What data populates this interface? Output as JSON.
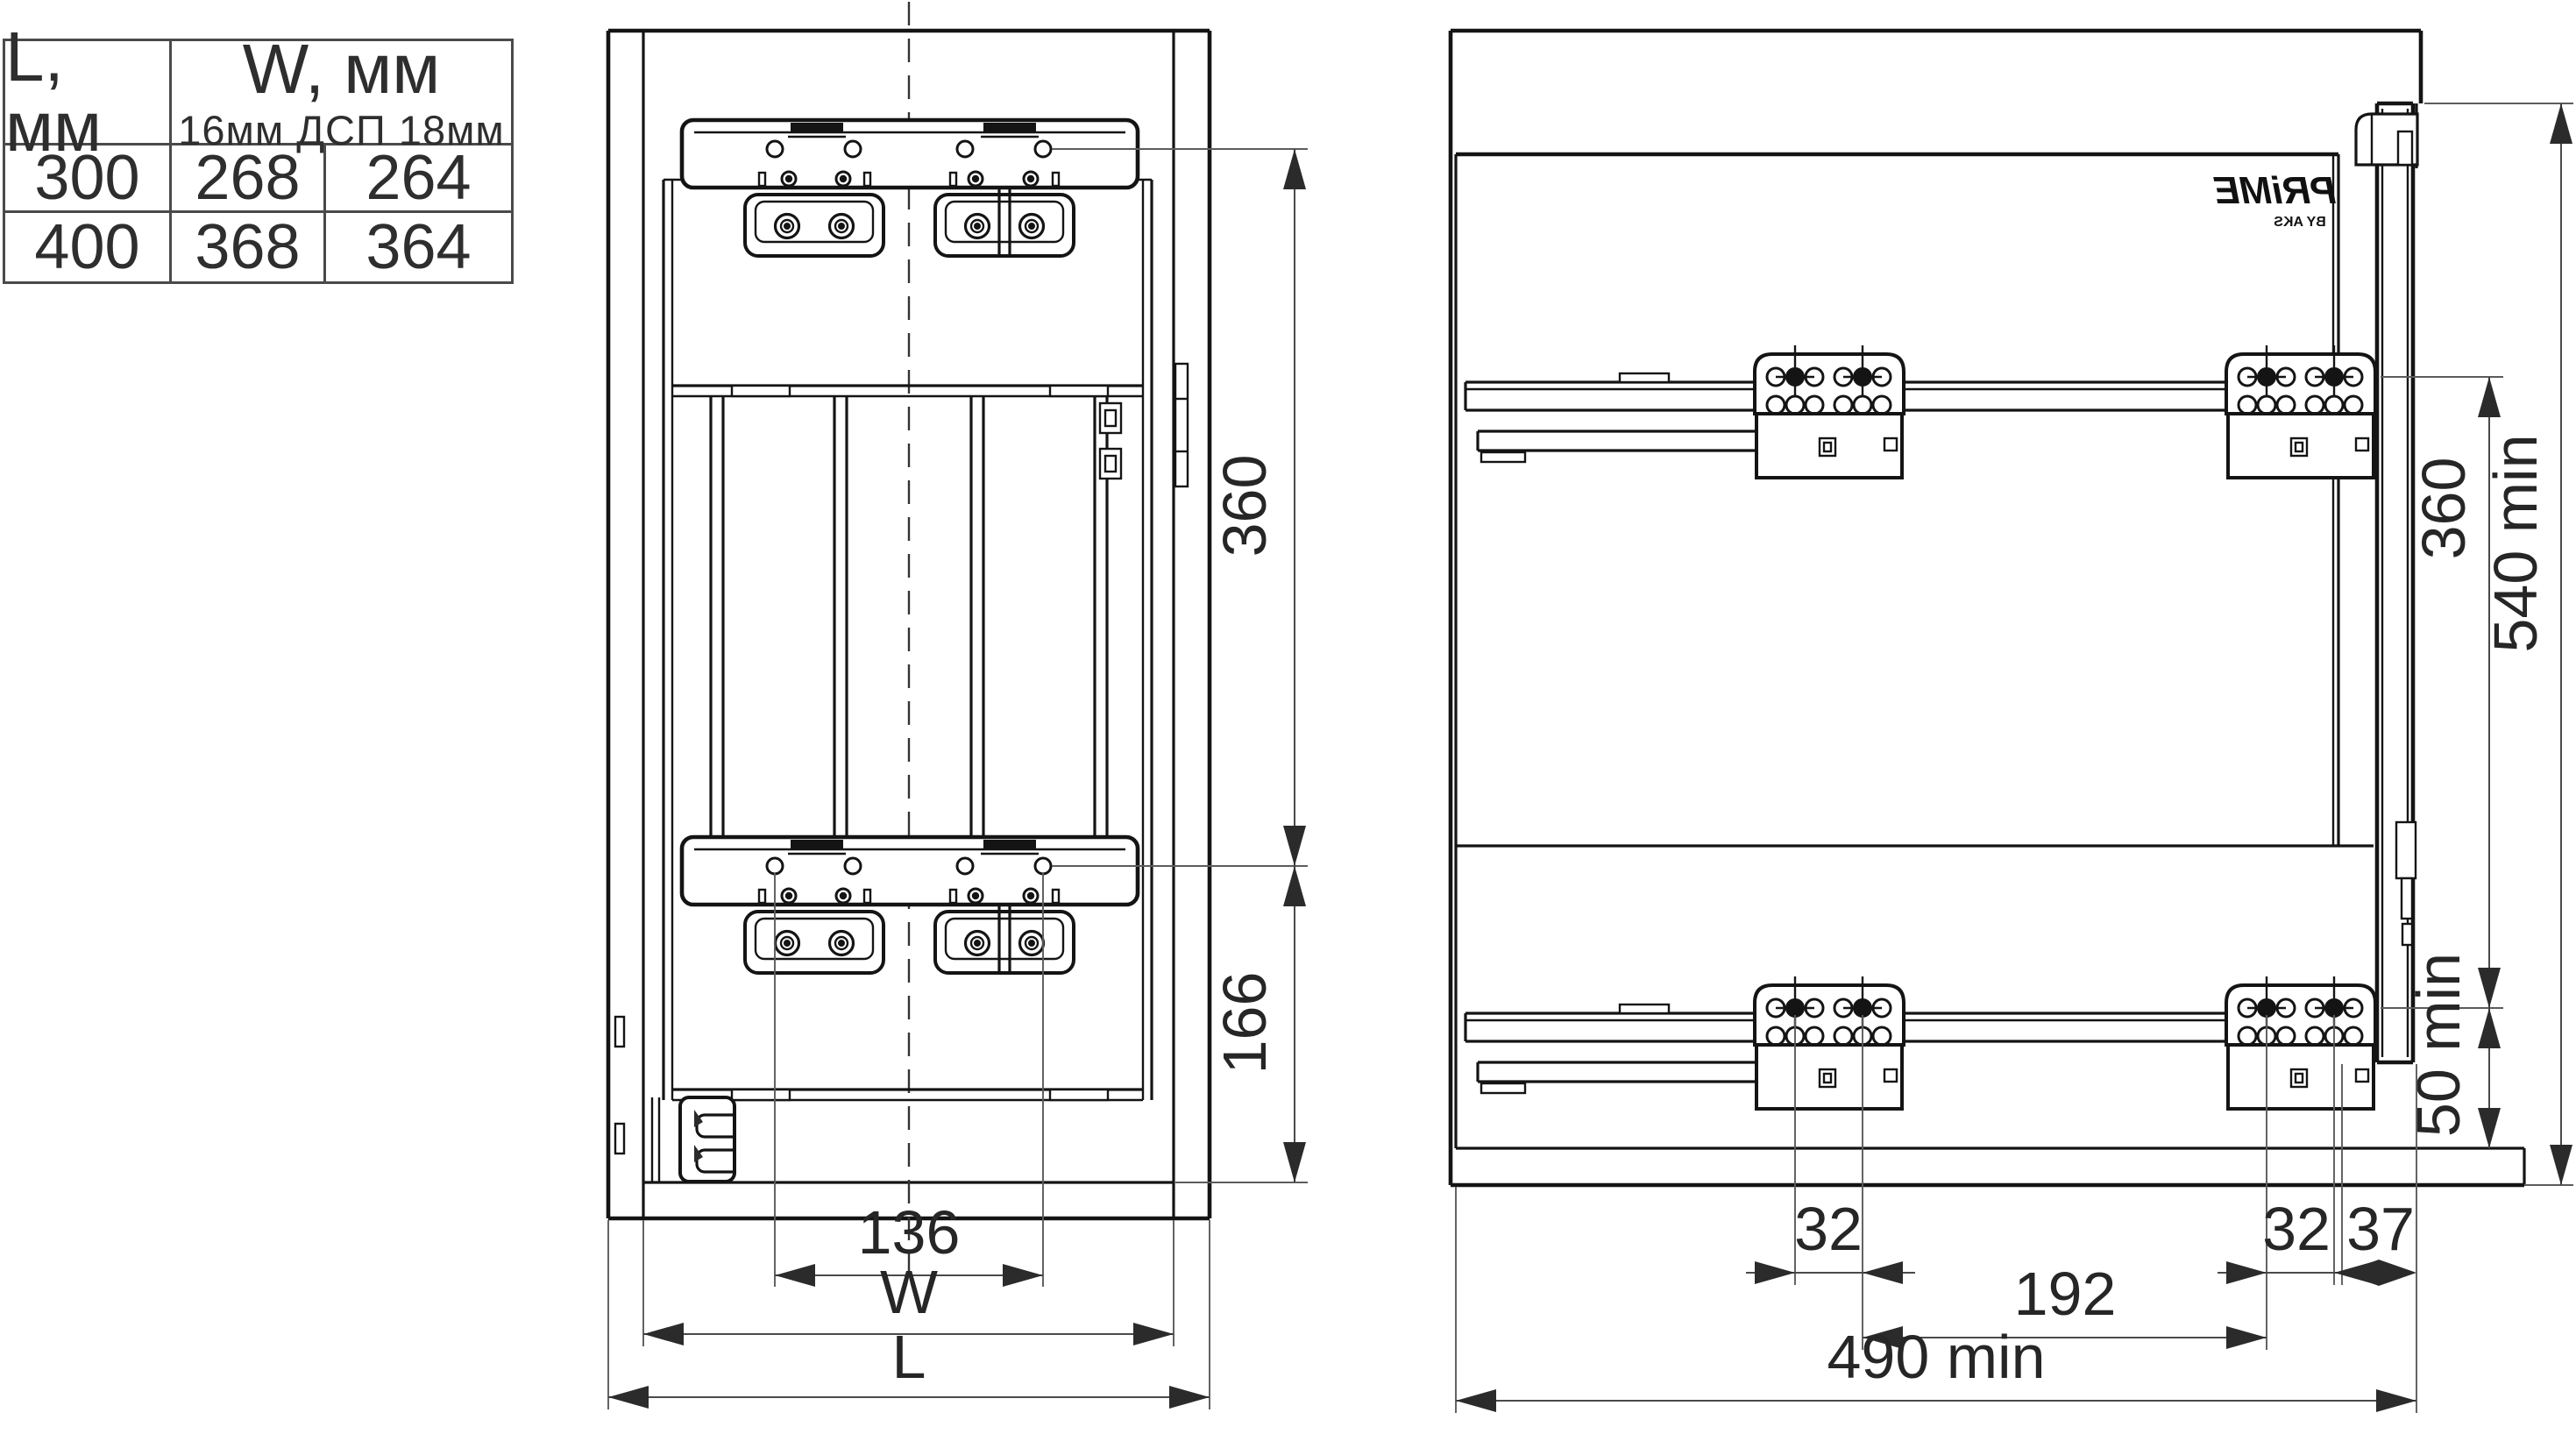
{
  "table": {
    "header_l": "L, мм",
    "header_w": "W, мм",
    "header_w_sub": "16мм ДСП 18мм",
    "rows": [
      {
        "l": "300",
        "w16": "268",
        "w18": "264"
      },
      {
        "l": "400",
        "w16": "368",
        "w18": "364"
      }
    ]
  },
  "front_view": {
    "dim_360": "360",
    "dim_166": "166",
    "dim_136": "136",
    "dim_w": "W",
    "dim_l": "L"
  },
  "side_view": {
    "logo": "PRiME",
    "logo_sub": "BY AKS",
    "dim_540": "540 min",
    "dim_360": "360",
    "dim_50": "50 min",
    "dim_32_left": "32",
    "dim_32_right": "32",
    "dim_37": "37",
    "dim_192": "192",
    "dim_490": "490 min"
  }
}
